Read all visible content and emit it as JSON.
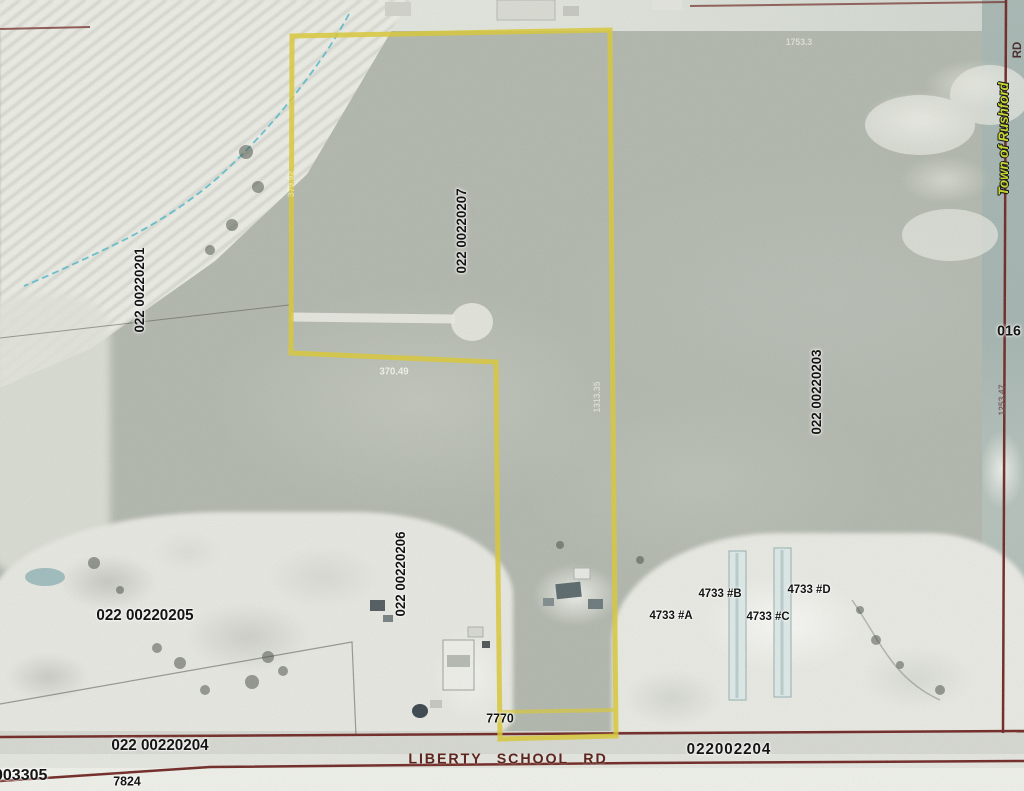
{
  "labels": {
    "parcel_201": "022 00220201",
    "parcel_207": "022 00220207",
    "parcel_203": "022 00220203",
    "parcel_206": "022 00220206",
    "parcel_205": "022 00220205",
    "parcel_204_left": "022 00220204",
    "parcel_204_right": "022002204",
    "parcel_003305": "003305",
    "parcel_016": "016",
    "address_7824": "7824",
    "address_7770": "7770",
    "address_4733a": "4733 #A",
    "address_4733b": "4733 #B",
    "address_4733c": "4733 #C",
    "address_4733d": "4733 #D",
    "road_liberty": "LIBERTY SCHOOL RD",
    "road_rd_partial": "RD",
    "town": "Town of Rushford"
  },
  "survey_numbers": {
    "s370": "370.49",
    "s1253": "1253.47",
    "s1313": "1313.35",
    "s379": "379.92",
    "s1753": "1753.3"
  },
  "colors": {
    "parcel_boundary": "#d9c832",
    "road_line": "#6e2420",
    "creek": "#45b4c8",
    "road_text": "#5e2620",
    "town_text": "#c6d531",
    "label_text": "#141414"
  }
}
